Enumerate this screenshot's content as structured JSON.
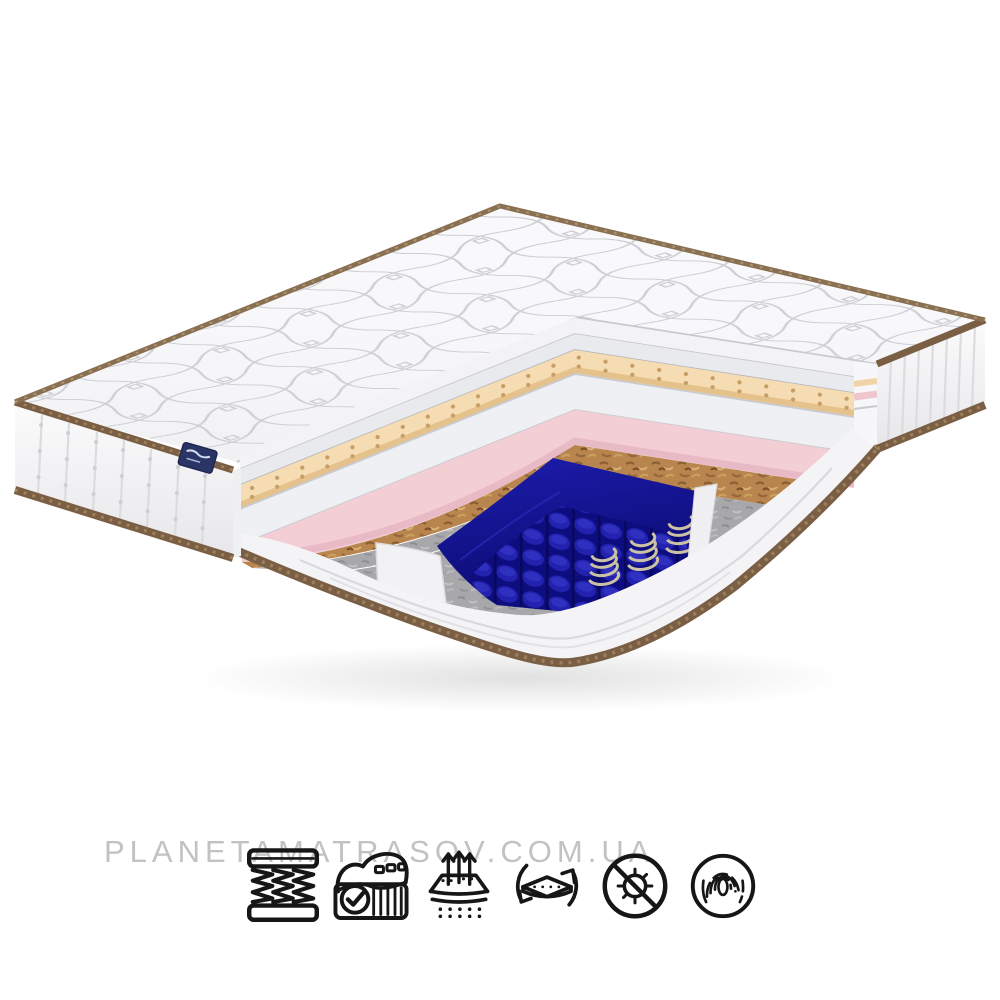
{
  "page": {
    "background_color": "#ffffff"
  },
  "watermark": {
    "text": "PLANETAMATRASOV.COM.UA",
    "color": "#c2c2c2"
  },
  "mattress": {
    "description": "3D cutaway render of a two-sided spring mattress",
    "brand_tag_color": "#2a3566",
    "piping_color": "#7b5f45",
    "layers": [
      {
        "name": "quilted-top-cover",
        "color": "#f8f8fa"
      },
      {
        "name": "soft-white-foam",
        "color": "#e9eaee"
      },
      {
        "name": "perforated-latex",
        "color": "#f6dcb2"
      },
      {
        "name": "white-foam",
        "color": "#eff0f3"
      },
      {
        "name": "pink-soft-foam",
        "color": "#f3ced5"
      },
      {
        "name": "coconut-coir",
        "color": "#b8854e"
      },
      {
        "name": "felt",
        "color": "#a7a7a9"
      },
      {
        "name": "pocket-spring-block",
        "color": "#12129a"
      },
      {
        "name": "steel-spring-coils",
        "color": "#c9c0a2"
      },
      {
        "name": "bottom-cover",
        "color": "#f4f4f6"
      }
    ]
  },
  "features": {
    "icons": [
      {
        "name": "bonnel-springs-icon"
      },
      {
        "name": "mattress-quality-check-icon"
      },
      {
        "name": "breathability-icon"
      },
      {
        "name": "flip-rotate-icon"
      },
      {
        "name": "antibacterial-icon"
      },
      {
        "name": "fingerprint-orthopedic-icon"
      }
    ]
  }
}
